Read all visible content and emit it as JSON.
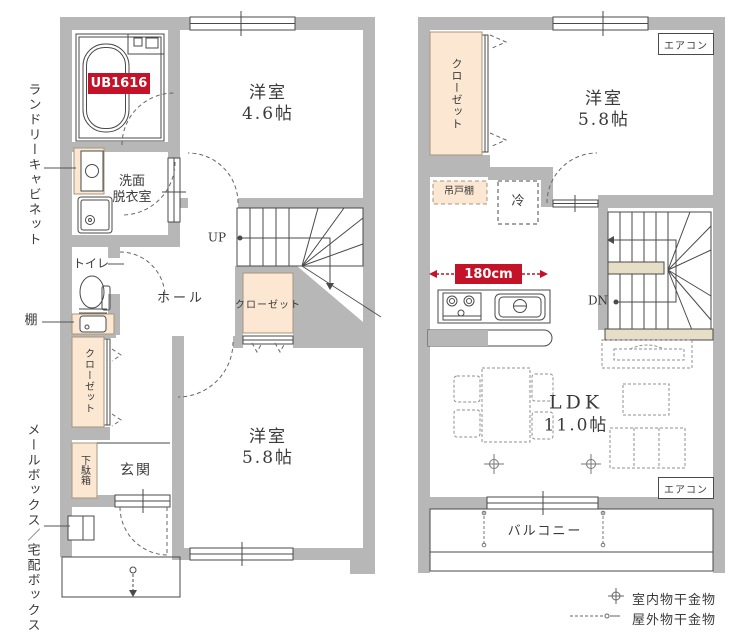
{
  "palette": {
    "wall": "#b7b7b7",
    "accent_red": "#c41228",
    "storage_beige": "#fbe7d2",
    "landing_beige": "#e6dec6"
  },
  "floor1": {
    "ub_label": "UB1616",
    "bedroom1": {
      "name": "洋室",
      "size": "4.6帖"
    },
    "washroom": {
      "line1": "洗面",
      "line2": "脱衣室"
    },
    "toilet_label": "トイレ",
    "shelf_label": "棚",
    "laundry_cabinet_label": "ランドリーキャビネット",
    "hall_label": "ホール",
    "up_label": "UP",
    "closet_hall_label": "クローゼット",
    "closet_side_label": "クローゼット",
    "bedroom2": {
      "name": "洋室",
      "size": "5.8帖"
    },
    "entrance_label": "玄関",
    "shoebox_label": "下駄箱",
    "mailbox_label": "メールボックス／宅配ボックス"
  },
  "floor2": {
    "closet_label": "クローゼット",
    "bedroom": {
      "name": "洋室",
      "size": "5.8帖"
    },
    "aircon_top_label": "エアコン",
    "aircon_bottom_label": "エアコン",
    "hanging_cupboard_label": "吊戸棚",
    "fridge_label": "冷",
    "kitchen_width_label": "180cm",
    "dn_label": "DN",
    "ldk": {
      "name": "LDK",
      "size": "11.0帖"
    },
    "balcony_label": "バルコニー"
  },
  "legend": {
    "indoor_label": "室内物干金物",
    "outdoor_label": "屋外物干金物"
  }
}
